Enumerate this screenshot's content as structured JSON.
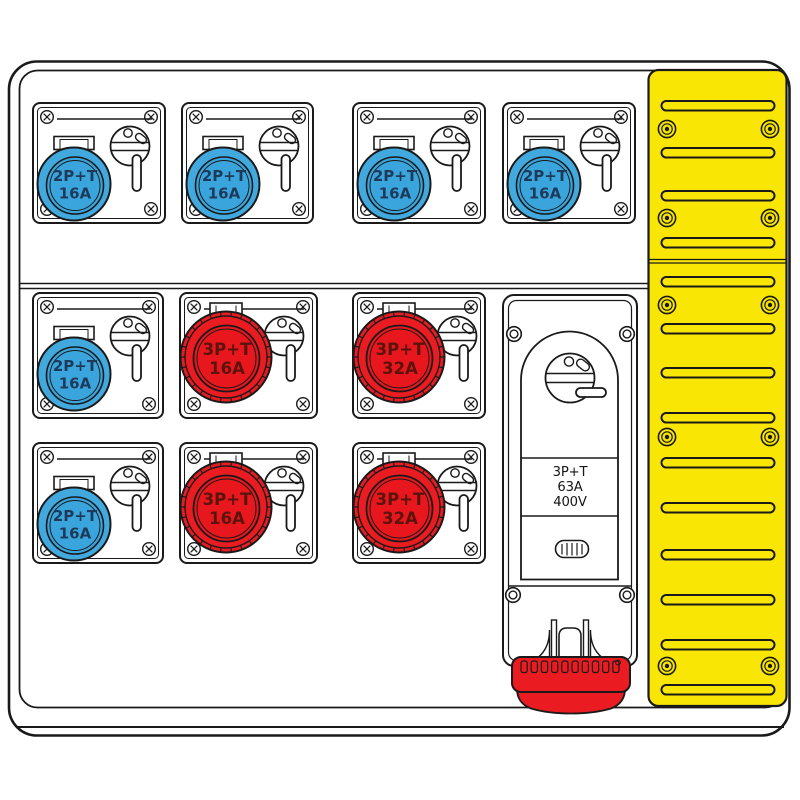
{
  "title": "Industrial socket distribution board - technical line drawing",
  "colors": {
    "blue": "#42a9de",
    "blue_face": "#3aa5dc",
    "blue_text": "#1e3a5a",
    "red": "#ea1c21",
    "red_face": "#e8161d",
    "red_text": "#5a140c",
    "yellow": "#f9e604",
    "line": "#1a1a1a"
  },
  "socket_units": [
    {
      "x": 33,
      "y": 103,
      "w": 132,
      "h": 120,
      "type": "blue",
      "line1": "2P+T",
      "line2": "16A"
    },
    {
      "x": 182,
      "y": 103,
      "w": 131,
      "h": 120,
      "type": "blue",
      "line1": "2P+T",
      "line2": "16A"
    },
    {
      "x": 353,
      "y": 103,
      "w": 132,
      "h": 120,
      "type": "blue",
      "line1": "2P+T",
      "line2": "16A"
    },
    {
      "x": 503,
      "y": 103,
      "w": 132,
      "h": 120,
      "type": "blue",
      "line1": "2P+T",
      "line2": "16A"
    },
    {
      "x": 33,
      "y": 293,
      "w": 130,
      "h": 125,
      "type": "blue",
      "line1": "2P+T",
      "line2": "16A"
    },
    {
      "x": 180,
      "y": 293,
      "w": 137,
      "h": 125,
      "type": "red",
      "line1": "3P+T",
      "line2": "16A"
    },
    {
      "x": 353,
      "y": 293,
      "w": 132,
      "h": 125,
      "type": "red",
      "line1": "3P+T",
      "line2": "32A"
    },
    {
      "x": 33,
      "y": 443,
      "w": 130,
      "h": 120,
      "type": "blue",
      "line1": "2P+T",
      "line2": "16A"
    },
    {
      "x": 180,
      "y": 443,
      "w": 137,
      "h": 120,
      "type": "red",
      "line1": "3P+T",
      "line2": "16A"
    },
    {
      "x": 353,
      "y": 443,
      "w": 132,
      "h": 120,
      "type": "red",
      "line1": "3P+T",
      "line2": "32A"
    }
  ],
  "main_switch_unit": {
    "label_line1": "3P+T",
    "label_line2": "63A",
    "label_line3": "400V"
  },
  "yellow_panel": {
    "slot_tops": [
      101,
      148,
      191,
      238,
      277,
      324,
      368,
      413,
      458,
      503,
      550,
      595,
      640,
      685
    ],
    "screw_rows": [
      129,
      218,
      305,
      437,
      666
    ],
    "screw_cols": [
      667,
      770
    ],
    "seam_y": 261
  }
}
